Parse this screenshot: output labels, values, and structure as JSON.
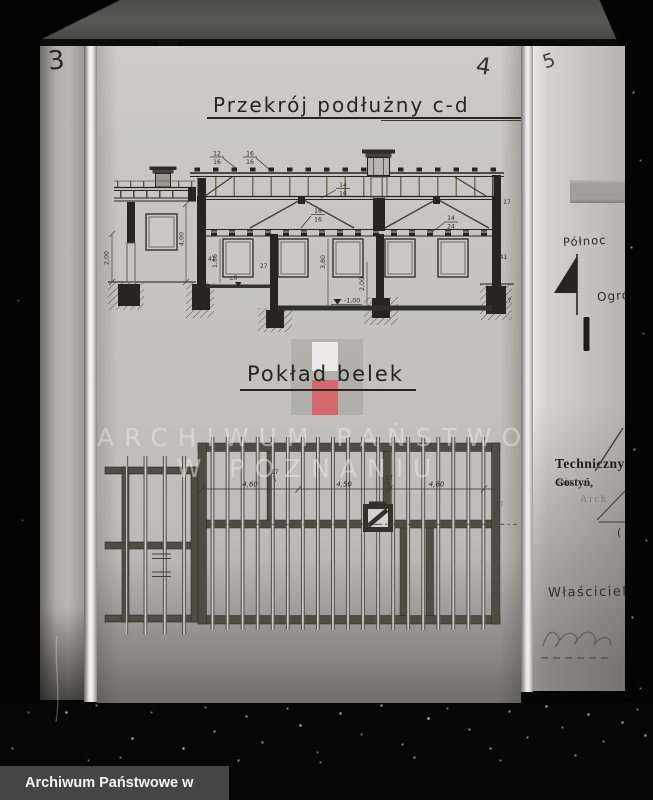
{
  "footer": {
    "label": "Archiwum Państwowe w Poznaniu"
  },
  "watermark": {
    "line1": "ARCHIWUM PAŃSTWOWE",
    "line2": "W POZNANIU"
  },
  "pages": {
    "left_number": "3",
    "main_number": "4",
    "right_number": "5"
  },
  "section": {
    "title": "Przekrój podłużny c-d",
    "labels": {
      "rafter1": {
        "top": "12",
        "bottom": "16"
      },
      "rafter2": {
        "top": "16",
        "bottom": "16"
      },
      "purlin": {
        "top": "14",
        "bottom": "16"
      },
      "beam_mid": {
        "top": "16",
        "bottom": "16"
      },
      "joist": {
        "top": "14",
        "bottom": "24"
      },
      "wall_right_top": "17",
      "wall_right_mid": "41",
      "wall_right_bottom": "17",
      "h_annex": "2,00",
      "h_room_left": "4,00",
      "h_window": "1,86",
      "wall_left": "41",
      "wall_mid": "27",
      "h_room_main": "3,80",
      "h_cellar": "2,00",
      "level_zero": "±0",
      "level_minus": "-1,00"
    }
  },
  "plan": {
    "title": "Pokład belek",
    "dims": {
      "bay1": "4,60",
      "bay2": "4,50",
      "bay3": "4,60"
    },
    "labels": {
      "wall_a": "17",
      "wall_b": "17",
      "edge_mark": "17"
    }
  },
  "margin_notes": {
    "north": "Północ",
    "garden": "Ogró",
    "technical": "Techniczny",
    "place": "Gostyń,",
    "date_dots": " dnia.......",
    "arch": "Arch",
    "owner": "Właściciel:",
    "paren": "("
  }
}
